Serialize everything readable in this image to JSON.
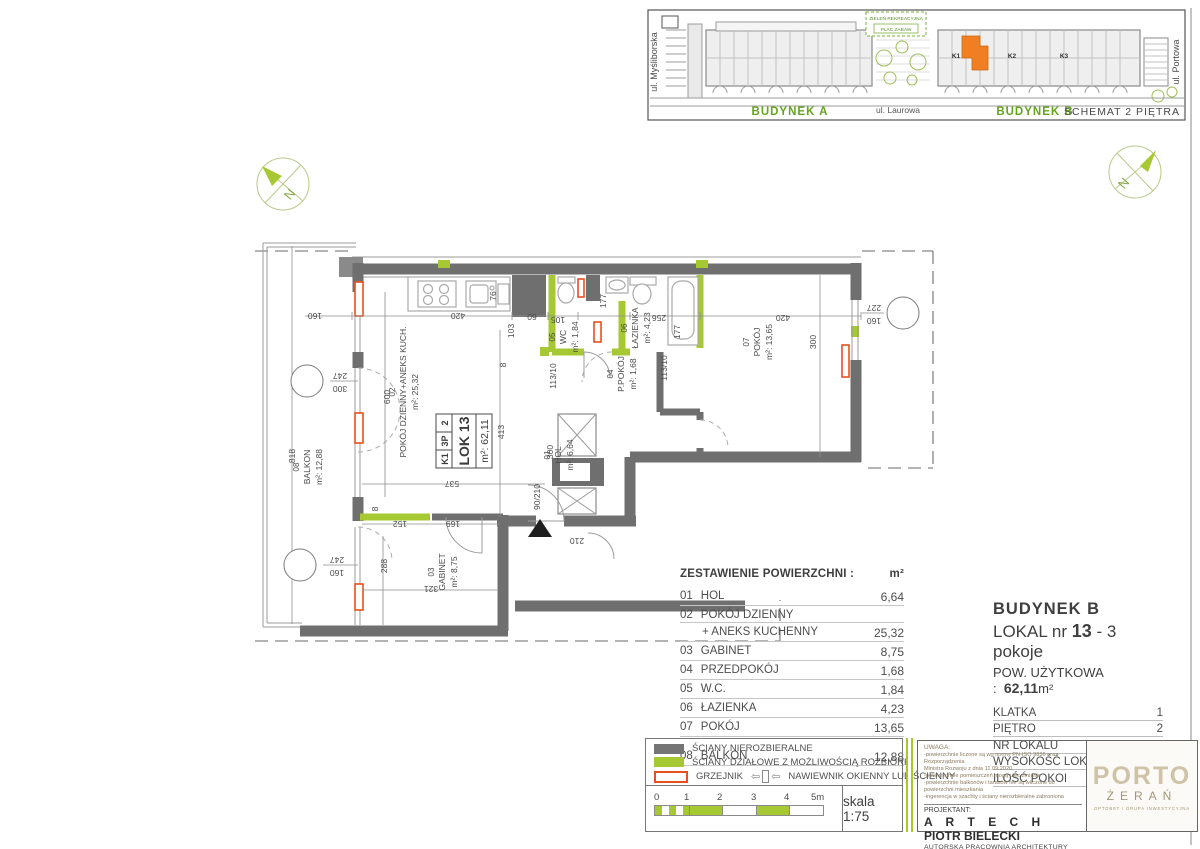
{
  "site": {
    "street_left": "ul. Myśliborska",
    "street_right": "ul. Portowa",
    "green1": "ZIELEŃ REKREACYJNA",
    "green2": "PLAC ZABAW",
    "street_bottom": "ul. Laurowa",
    "bldg_a": "BUDYNEK A",
    "bldg_b": "BUDYNEK B",
    "schemat": "SCHEMAT 2 PIĘTRA",
    "k1": "K1",
    "k2": "K2",
    "k3": "K3",
    "unit_highlight_color": "#ef7f22"
  },
  "plan": {
    "north": "N",
    "card": {
      "c1": "K1",
      "c2": "3P",
      "c3": "2",
      "l1": "LOK 13",
      "l2": "m²: 62,11"
    },
    "rooms": [
      {
        "no": "01",
        "name": "HOL",
        "area": "m²: 6,64"
      },
      {
        "no": "02",
        "name": "POKÓJ DZIENNY+ANEKS KUCH.",
        "area": "m²: 25,32"
      },
      {
        "no": "03",
        "name": "GABINET",
        "area": "m²: 8,75"
      },
      {
        "no": "04",
        "name": "P.POKÓJ",
        "area": "m²: 1,68"
      },
      {
        "no": "05",
        "name": "WC",
        "area": "m²: 1,84"
      },
      {
        "no": "06",
        "name": "ŁAZIENKA",
        "area": "m²: 4,23"
      },
      {
        "no": "07",
        "name": "POKÓJ",
        "area": "m²: 13,65"
      },
      {
        "no": "08",
        "name": "BALKON",
        "area": "m²: 12,88"
      }
    ],
    "dims": [
      "420",
      "103",
      "8",
      "60",
      "105",
      "177",
      "256",
      "177",
      "113/10",
      "113/10",
      "420",
      "300",
      "600",
      "413",
      "300",
      "90/210",
      "210",
      "537",
      "152",
      "8",
      "169",
      "288",
      "321",
      "818",
      "160",
      "76"
    ],
    "markers": [
      {
        "a": "247",
        "b": "300"
      },
      {
        "a": "247",
        "b": "160"
      },
      {
        "a": "227",
        "b": "160"
      }
    ],
    "wall_gray": "#6f6f6f",
    "partition_green": "#a6c832",
    "radiator_orange": "#e8501e"
  },
  "area_table": {
    "title": "ZESTAWIENIE POWIERZCHNI :",
    "unit": "m²",
    "rows": [
      {
        "no": "01",
        "name": "HOL",
        "value": "6,64"
      },
      {
        "no": "02",
        "name": "POKÓJ DZIENNY",
        "value": ""
      },
      {
        "no": "",
        "name": "+ ANEKS KUCHENNY",
        "value": "25,32"
      },
      {
        "no": "03",
        "name": "GABINET",
        "value": "8,75"
      },
      {
        "no": "04",
        "name": "PRZEDPOKÓJ",
        "value": "1,68"
      },
      {
        "no": "05",
        "name": "W.C.",
        "value": "1,84"
      },
      {
        "no": "06",
        "name": "ŁAZIENKA",
        "value": "4,23"
      },
      {
        "no": "07",
        "name": "POKÓJ",
        "value": "13,65"
      },
      {
        "no": "08",
        "name": "BALKON",
        "value": "12,88"
      }
    ]
  },
  "info": {
    "building": "BUDYNEK B",
    "lokal_label": "LOKAL  nr ",
    "lokal_no": "13",
    "lokal_rest": "  -  3 pokoje",
    "pow_label": "POW. UŻYTKOWA :",
    "pow_value": "62,11",
    "pow_unit": "m²",
    "rows": [
      {
        "l": "KLATKA",
        "v": "1"
      },
      {
        "l": "PIĘTRO",
        "v": "2"
      },
      {
        "l": "NR LOKALU",
        "v": "13"
      },
      {
        "l": "WYSOKOŚĆ LOKALU",
        "v": "2,73 m"
      },
      {
        "l": "ILOŚĆ POKOI",
        "v": "3"
      }
    ]
  },
  "legend": {
    "item1": "ŚCIANY NIEROZBIERALNE",
    "item2": "ŚCIANY DZIAŁOWE Z MOŻLIWOŚCIĄ ROZBIÓRKI",
    "item3": "GRZEJNIK",
    "item4": "NAWIEWNIK OKIENNY LUB ŚCIENNY",
    "scale_label": "skala 1:75",
    "ticks": [
      "0",
      "1",
      "2",
      "3",
      "4",
      "5m"
    ]
  },
  "title_block": {
    "uwaga_title": "UWAGA:",
    "uwaga_lines": [
      "-powierzchnie liczone są wg normy PN-ISO 9836 oraz Rozporządzenia",
      "  Ministra Rozwoju z dnia 11.09.2020,",
      "-powierzchnie pomieszczeń mogą ulec zmianie",
      "-powierzchnie balkonów i tarasów nie są wliczone do powierzchni mieszkania",
      "-ingerencja w szachty i ściany nierozbieralne zabroniona"
    ],
    "projektant_label": "PROJEKTANT:",
    "architect_1": "A R T E C H",
    "architect_2": " PIOTR BIELECKI",
    "studio": "AUTORSKA PRACOWNIA ARCHITEKTURY",
    "address": "ul. Koncertowa 11 m 26, 02-787 Warszawa"
  },
  "logo": {
    "line1": "PORTO",
    "line2": "ŻERAŃ",
    "line3": "OPTOBET I GRUPA INWESTYCYJNA",
    "brand_color": "#cfc2a6"
  }
}
